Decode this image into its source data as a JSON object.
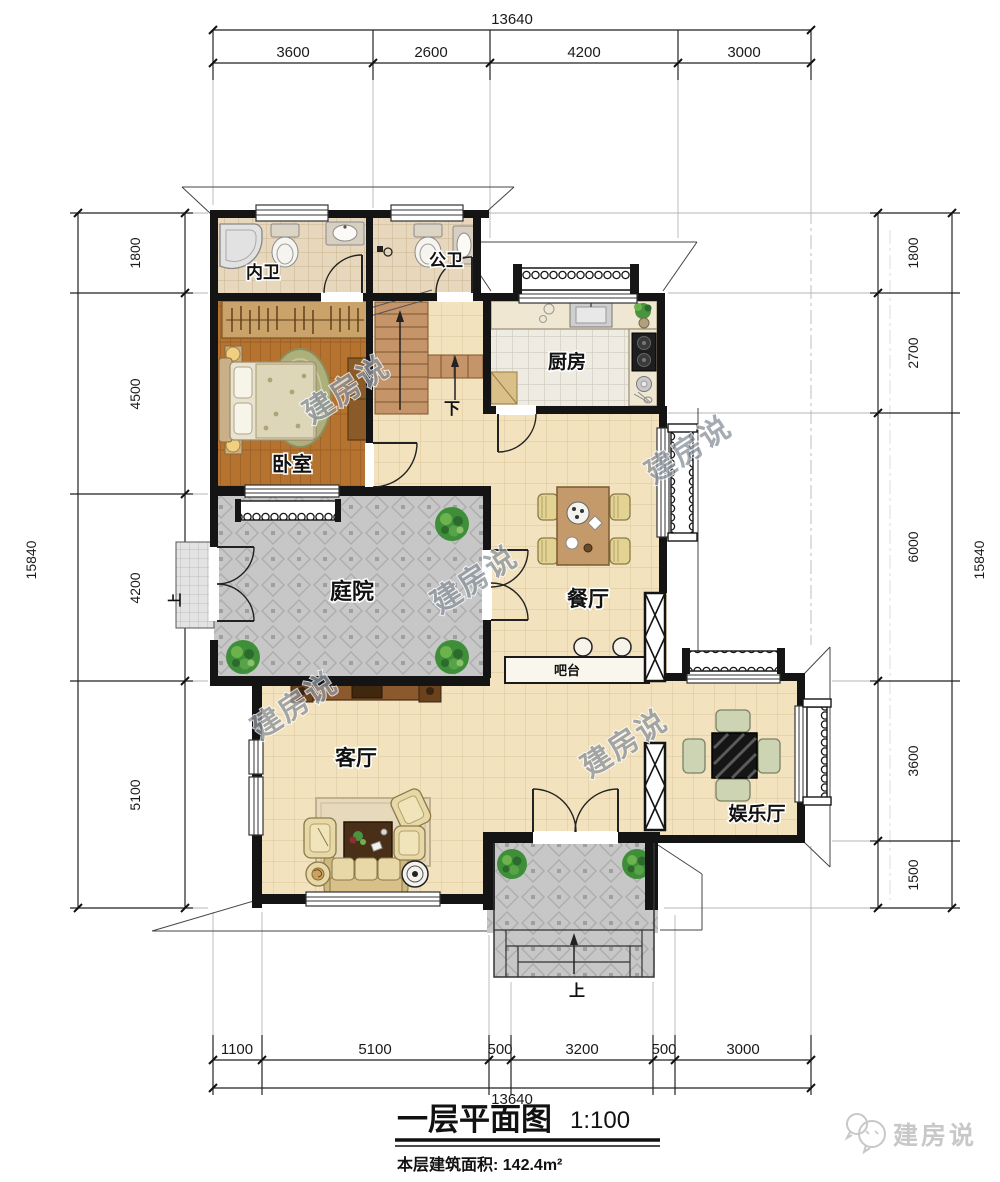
{
  "dimensions": {
    "top": {
      "total": "13640",
      "segments": [
        "3600",
        "2600",
        "4200",
        "3000"
      ]
    },
    "bottom": {
      "total": "13640",
      "segments": [
        "1100",
        "5100",
        "500",
        "3200",
        "500",
        "3000"
      ]
    },
    "left": {
      "total": "15840",
      "segments": [
        "1800",
        "4500",
        "4200",
        "5100"
      ]
    },
    "right": {
      "total": "15840",
      "segments": [
        "1800",
        "2700",
        "6000",
        "3600",
        "1500"
      ]
    }
  },
  "rooms": {
    "inner_bath": "内卫",
    "public_bath": "公卫",
    "kitchen": "厨房",
    "bedroom": "卧室",
    "courtyard": "庭院",
    "dining": "餐厅",
    "bar": "吧台",
    "living": "客厅",
    "entertainment": "娱乐厅"
  },
  "annotations": {
    "stair_down": "下",
    "entry_up": "上",
    "west_up": "上"
  },
  "title": {
    "name": "一层平面图",
    "scale": "1:100",
    "area": "本层建筑面积: 142.4m²"
  },
  "watermark": {
    "text": "建房说"
  },
  "logo": {
    "text": "建房说"
  },
  "colors": {
    "wall": "#141414",
    "cream_tile": "#f2e2bd",
    "gray_tile": "#c7c7c7",
    "wood": "#b5732f",
    "accent_green": "#4a9440"
  }
}
